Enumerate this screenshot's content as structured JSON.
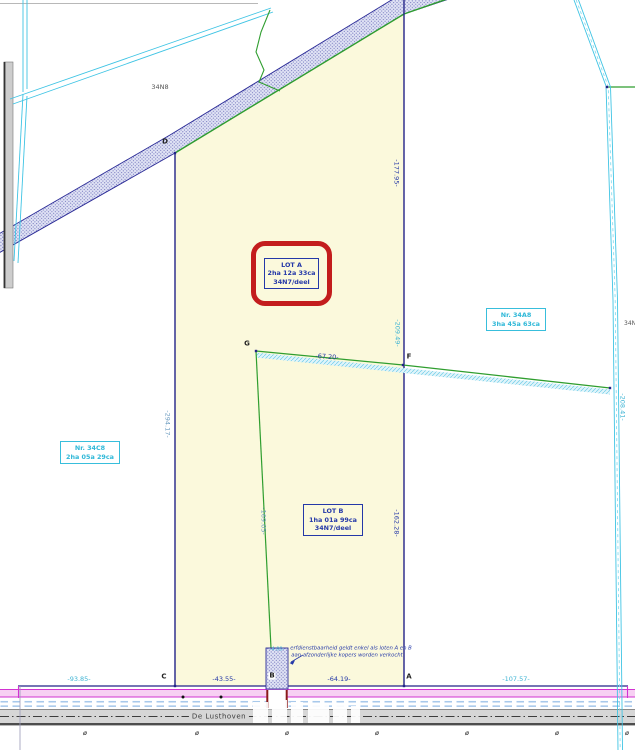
{
  "plan": {
    "lot_a": {
      "title": "LOT A",
      "area": "2ha 12a 33ca",
      "parcel": "34N7/deel"
    },
    "lot_b": {
      "title": "LOT B",
      "area": "1ha 01a 99ca",
      "parcel": "34N7/deel"
    },
    "neighbor_right": {
      "title": "Nr. 34A8",
      "area": "3ha 45a 63ca"
    },
    "neighbor_left": {
      "title": "Nr. 34C8",
      "area": "2ha 05a 29ca"
    },
    "label_34n8": "34N8",
    "label_right_edge": "34N",
    "watercourse_marks": "· · · · · · · ·",
    "note_line1": "erfdienstbaarheid geldt enkel als loten A en B",
    "note_line2": "aan afzonderlijke kopers worden verkocht"
  },
  "points": {
    "a": "A",
    "b": "B",
    "c": "C",
    "d": "D",
    "f": "F",
    "g": "G"
  },
  "dimensions": {
    "west_side": "-294.17-",
    "east_upper": "-177.95-",
    "east_mid": "-209.49-",
    "east_lower": "-162.28-",
    "g_f": "-67.20-",
    "g_road": "-169.05-",
    "right_boundary": "-208.41-",
    "frontage_left": "-93.85-",
    "frontage_c_b": "-43.55-",
    "frontage_b_a": "-64.19-",
    "frontage_right": "-107.57-",
    "strip_width": "-4.00-"
  },
  "road": {
    "name": "De Lusthoven",
    "marker": "ø"
  },
  "colors": {
    "highlight_red": "#C31D1D",
    "parcel_yellow": "#FBF9DC",
    "plan_blue": "#2438A8",
    "cyan": "#2FB8D8",
    "magenta": "#D233D2",
    "green": "#2F9E2F"
  }
}
